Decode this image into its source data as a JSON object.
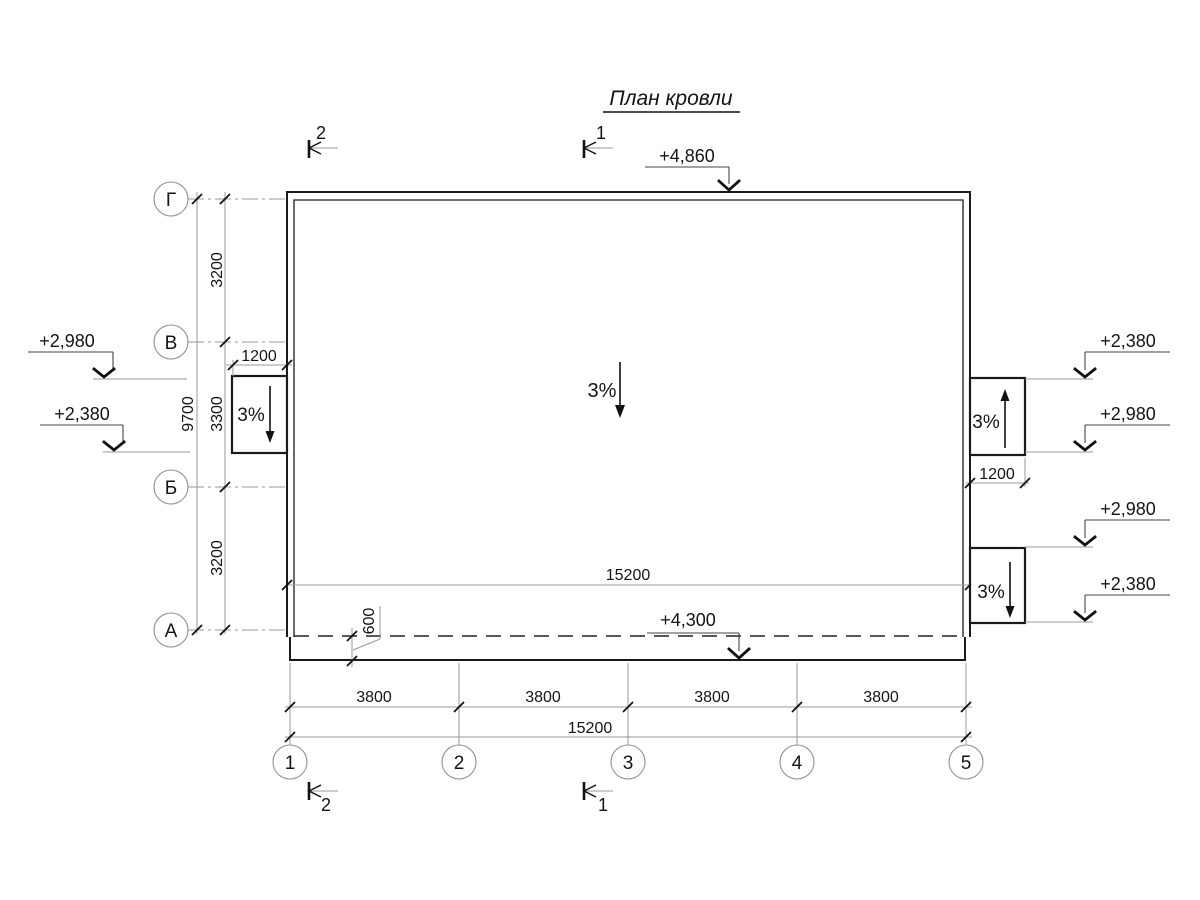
{
  "title": "План кровли",
  "axes": {
    "letters": [
      "Г",
      "В",
      "Б",
      "А"
    ],
    "numbers": [
      "1",
      "2",
      "3",
      "4",
      "5"
    ]
  },
  "dimensions": {
    "bottom_segments": [
      "3800",
      "3800",
      "3800",
      "3800"
    ],
    "bottom_total": "15200",
    "roof_length": "15200",
    "left_segments": [
      "3200",
      "3300",
      "3200"
    ],
    "left_total": "9700",
    "left_canopy_width": "1200",
    "right_canopy_width": "1200",
    "eave_overhang": "600"
  },
  "elevations": {
    "roof_top": "+4,860",
    "roof_eave": "+4,300",
    "left_upper": "+2,980",
    "left_lower": "+2,380",
    "right_upper_canopy_top": "+2,380",
    "right_upper_canopy_bottom": "+2,980",
    "right_lower_canopy_top": "+2,980",
    "right_lower_canopy_bottom": "+2,380"
  },
  "slopes": {
    "main": "3%",
    "left_canopy": "3%",
    "right_upper_canopy": "3%",
    "right_lower_canopy": "3%"
  },
  "sections": {
    "section_1": "1",
    "section_2": "2"
  }
}
